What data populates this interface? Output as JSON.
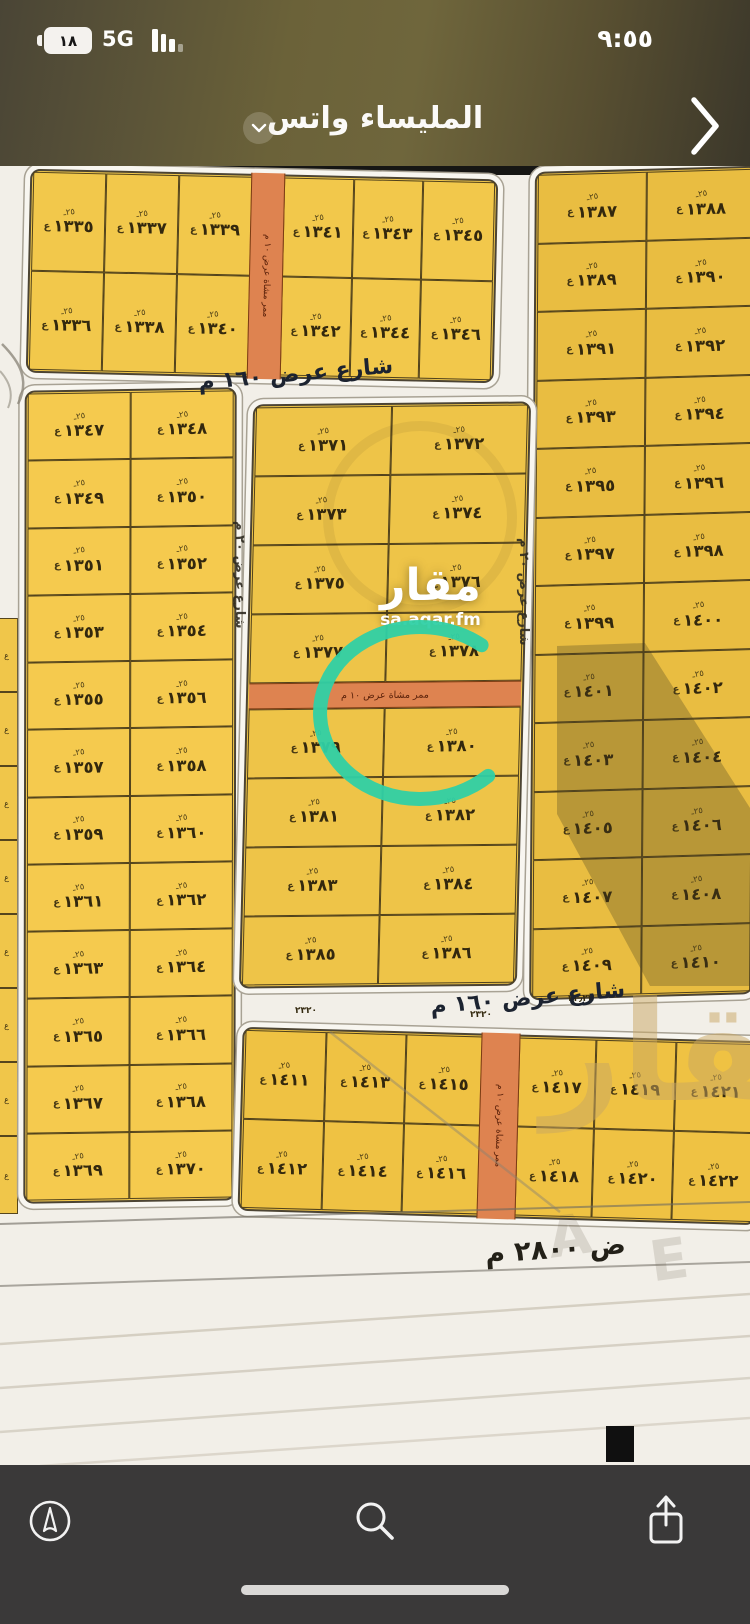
{
  "status_bar": {
    "time": "٩:٥٥",
    "battery": "١٨",
    "network": "5G"
  },
  "header": {
    "title": "المليساء واتس"
  },
  "map": {
    "streets": {
      "top": "شارع عرض ١٦٠ م",
      "bottom": "شارع عرض ١٦٠ م",
      "left_vertical": "شارع عرض ٢٠ م",
      "right_vertical": "شارع عرض ٢٠ م",
      "bottom_partial": "ض ٢٨٠٠ م"
    },
    "lane_label": "ممر مشاة عرض ١٠ م",
    "watermark": {
      "brand": "مقار",
      "site": "sa.aqar.fm",
      "ghost": "مقار",
      "ghost_letters": [
        "A",
        "E"
      ]
    },
    "highlight": {
      "plot": "١٣٨٠",
      "color": "#2fd0a5"
    },
    "cell_marks": {
      "top": "٢٥ـ",
      "side": "ع"
    },
    "micro_labels": [
      {
        "text": "٢٣٢٠",
        "x": 295,
        "y": 840
      },
      {
        "text": "٢٣٢٠",
        "x": 470,
        "y": 844
      },
      {
        "text": "٢٣٫٢٣",
        "x": 568,
        "y": 828
      }
    ],
    "blocks": [
      {
        "name": "block-north",
        "x": 28,
        "y": 8,
        "w": 462,
        "h": 198,
        "rot": 1.3,
        "skew": 0,
        "bg": "#f2c84b",
        "cols": "1.05fr 1.05fr 1.05fr 0.45fr 1fr 1fr 1.03fr",
        "lane": [
          47.2,
          7.0
        ],
        "rows": [
          [
            "١٣٣٥",
            "١٣٣٧",
            "١٣٣٩",
            "",
            "١٣٤١",
            "١٣٤٣",
            "١٣٤٥"
          ],
          [
            "١٣٣٦",
            "١٣٣٨",
            "١٣٤٠",
            "",
            "١٣٤٢",
            "١٣٤٤",
            "١٣٤٦"
          ]
        ]
      },
      {
        "name": "block-east",
        "x": 532,
        "y": 3,
        "w": 218,
        "h": 822,
        "rot": -1.6,
        "skew": -2,
        "bg": "#e9bd41",
        "cols": "1fr 1fr",
        "rows": [
          [
            "١٣٨٧",
            "١٣٨٨"
          ],
          [
            "١٣٨٩",
            "١٣٩٠"
          ],
          [
            "١٣٩١",
            "١٣٩٢"
          ],
          [
            "١٣٩٣",
            "١٣٩٤"
          ],
          [
            "١٣٩٥",
            "١٣٩٦"
          ],
          [
            "١٣٩٧",
            "١٣٩٨"
          ],
          [
            "١٣٩٩",
            "١٤٠٠"
          ],
          [
            "١٤٠١",
            "١٤٠٢"
          ],
          [
            "١٤٠٣",
            "١٤٠٤"
          ],
          [
            "١٤٠٥",
            "١٤٠٦"
          ],
          [
            "١٤٠٧",
            "١٤٠٨"
          ],
          [
            "١٤٠٩",
            "١٤١٠"
          ]
        ]
      },
      {
        "name": "block-west",
        "x": 24,
        "y": 223,
        "w": 206,
        "h": 807,
        "rot": -0.9,
        "skew": -1,
        "bg": "#f5ca4e",
        "cols": "1fr 1fr",
        "rows": [
          [
            "١٣٤٧",
            "١٣٤٨"
          ],
          [
            "١٣٤٩",
            "١٣٥٠"
          ],
          [
            "١٣٥١",
            "١٣٥٢"
          ],
          [
            "١٣٥٣",
            "١٣٥٤"
          ],
          [
            "١٣٥٥",
            "١٣٥٦"
          ],
          [
            "١٣٥٧",
            "١٣٥٨"
          ],
          [
            "١٣٥٩",
            "١٣٦٠"
          ],
          [
            "١٣٦١",
            "١٣٦٢"
          ],
          [
            "١٣٦٣",
            "١٣٦٤"
          ],
          [
            "١٣٦٥",
            "١٣٦٦"
          ],
          [
            "١٣٦٧",
            "١٣٦٨"
          ],
          [
            "١٣٦٩",
            "١٣٧٠"
          ]
        ]
      },
      {
        "name": "block-center",
        "x": 246,
        "y": 237,
        "w": 272,
        "h": 578,
        "rot": -0.6,
        "skew": -2,
        "bg": "#eec448",
        "cols": "1fr 1fr",
        "rowsT": "1fr 1fr 1fr 1fr 26px 1fr 1fr 1fr 1fr",
        "rows": [
          [
            "١٣٧١",
            "١٣٧٢"
          ],
          [
            "١٣٧٣",
            "١٣٧٤"
          ],
          [
            "١٣٧٥",
            "١٣٧٦"
          ],
          [
            "١٣٧٧",
            "١٣٧٨"
          ],
          "LANE",
          [
            "١٣٧٩",
            "١٣٨٠"
          ],
          [
            "١٣٨١",
            "١٣٨٢"
          ],
          [
            "١٣٨٣",
            "١٣٨٤"
          ],
          [
            "١٣٨٥",
            "١٣٨٦"
          ]
        ]
      },
      {
        "name": "block-south",
        "x": 240,
        "y": 868,
        "w": 512,
        "h": 178,
        "rot": 1.6,
        "skew": 0,
        "bg": "#efc243",
        "cols": "1fr 1fr 0.95fr 0.45fr 0.95fr 1fr 1fr",
        "lane": [
          46.2,
          7.1
        ],
        "rows": [
          [
            "١٤١١",
            "١٤١٣",
            "١٤١٥",
            "",
            "١٤١٧",
            "١٤١٩",
            "١٤٢١"
          ],
          [
            "١٤١٢",
            "١٤١٤",
            "١٤١٦",
            "",
            "١٤١٨",
            "١٤٢٠",
            "١٤٢٢"
          ]
        ]
      }
    ],
    "edge_fragments": [
      {
        "t": 452,
        "h": 72
      },
      {
        "t": 526,
        "h": 72
      },
      {
        "t": 600,
        "h": 72
      },
      {
        "t": 674,
        "h": 72
      },
      {
        "t": 748,
        "h": 72
      },
      {
        "t": 822,
        "h": 72
      },
      {
        "t": 896,
        "h": 72
      },
      {
        "t": 970,
        "h": 76
      }
    ]
  },
  "toolbar": {
    "icons": [
      "location",
      "search",
      "share"
    ]
  }
}
